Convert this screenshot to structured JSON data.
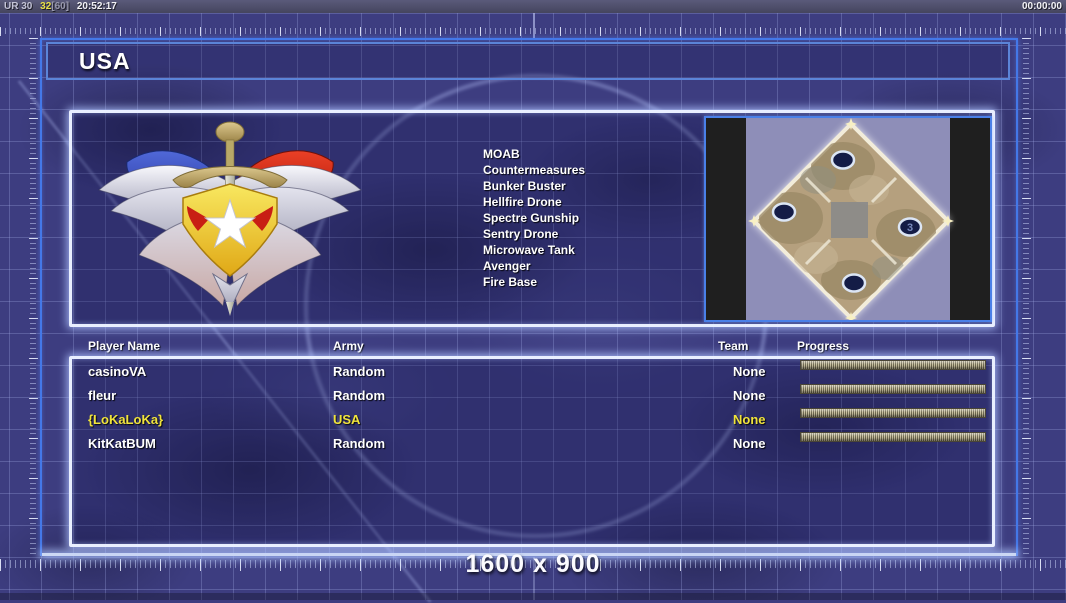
{
  "status_bar": {
    "renderer": "UR 30",
    "fps": "32",
    "fps_cap": "[60]",
    "clock": "20:52:17",
    "match_timer": "00:00:00"
  },
  "faction_title": "USA",
  "unit_list": [
    "MOAB",
    "Countermeasures",
    "Bunker Buster",
    "Hellfire Drone",
    "Spectre Gunship",
    "Sentry Drone",
    "Microwave Tank",
    "Avenger",
    "Fire Base"
  ],
  "map_preview": {
    "start_position_label": "3"
  },
  "player_table": {
    "headers": {
      "name": "Player Name",
      "army": "Army",
      "team": "Team",
      "progress": "Progress"
    },
    "rows": [
      {
        "name": "casinoVA",
        "army": "Random",
        "team": "None",
        "progress_percent": 100,
        "highlighted": false
      },
      {
        "name": "fleur",
        "army": "Random",
        "team": "None",
        "progress_percent": 100,
        "highlighted": false
      },
      {
        "name": "{LoKaLoKa}",
        "army": "USA",
        "team": "None",
        "progress_percent": 100,
        "highlighted": true
      },
      {
        "name": "KitKatBUM",
        "army": "Random",
        "team": "None",
        "progress_percent": 100,
        "highlighted": false
      }
    ]
  },
  "resolution_overlay": "1600 x 900",
  "colors": {
    "highlight_text": "#f0e33c",
    "frame_blue": "#4478e8",
    "background": "#3d3d80",
    "progress_bar_light": "#c6be9e",
    "progress_bar_dark": "#6e6850"
  }
}
